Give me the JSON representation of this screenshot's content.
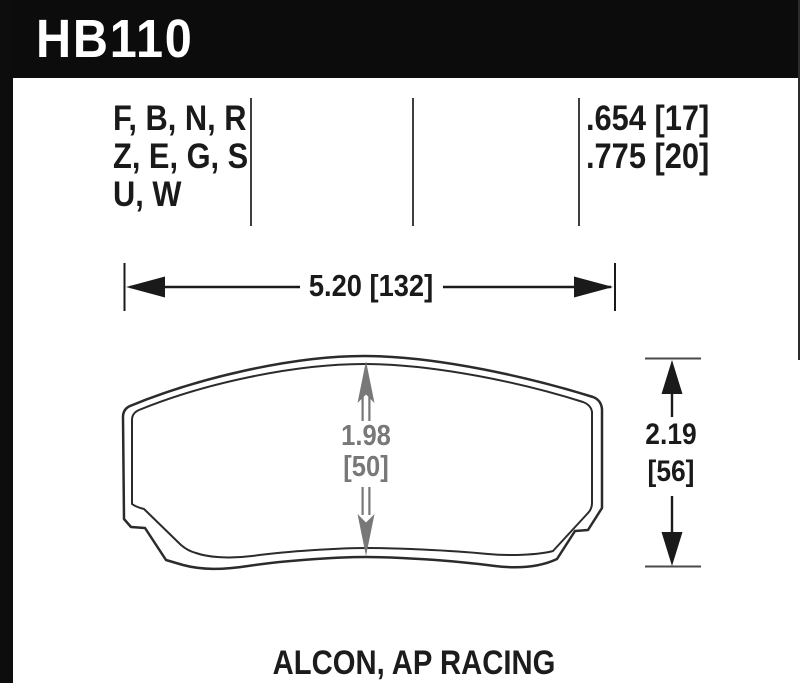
{
  "header": {
    "part_number": "HB110"
  },
  "compounds": {
    "line1": "F, B, N, R",
    "line2": "Z, E, G, S",
    "line3": "U, W"
  },
  "thickness": {
    "line1": ".654 [17]",
    "line2": ".775 [20]"
  },
  "dimensions": {
    "width": "5.20 [132]",
    "center_height_in": "1.98",
    "center_height_mm": "[50]",
    "overall_height_in": "2.19",
    "overall_height_mm": "[56]"
  },
  "applications": "ALCON, AP RACING",
  "colors": {
    "ink": "#1a1a1a",
    "dim_gray": "#78787a",
    "header_bg": "#0c0c0c"
  }
}
